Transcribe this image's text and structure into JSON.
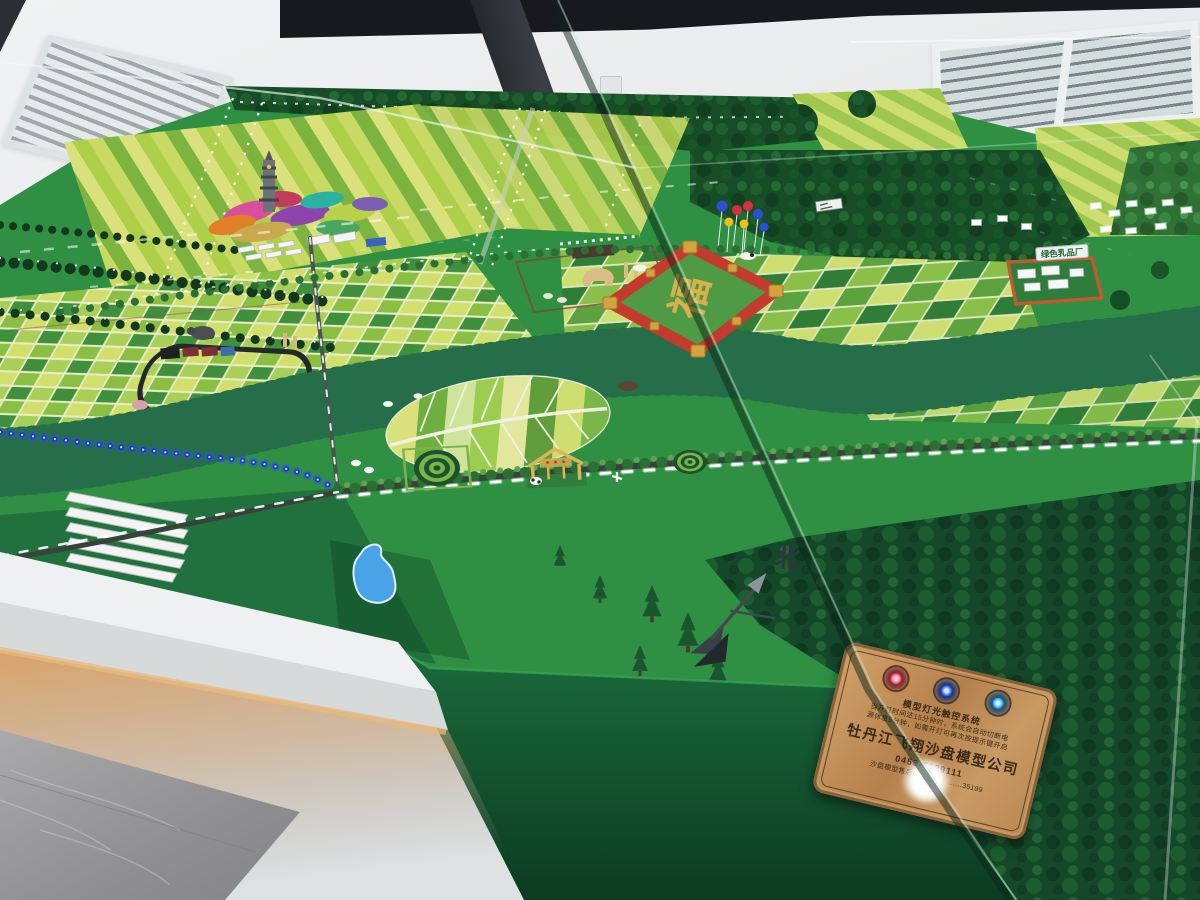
{
  "plaque": {
    "system_title": "模型灯光触控系统",
    "note_line1": "当开灯时间达15分钟时，系统会自动切断电",
    "note_line2": "源休息5分钟，如需开灯可再次按提示键开启",
    "company": "牡丹江飞翔沙盘模型公司",
    "phone": "0453-6629111",
    "hotline": "沙盘模型售后服务热线：……35199",
    "buttons": [
      {
        "name": "red-button",
        "color": "#ff4d6e"
      },
      {
        "name": "blue-button",
        "color": "#2f6bff"
      },
      {
        "name": "cyan-blue-button",
        "color": "#28a8ff"
      }
    ]
  },
  "model": {
    "north_label": "北",
    "emblem_character": "福",
    "factory_sign": "绿色乳品厂",
    "colors": {
      "turf": "#2f8f43",
      "forest_dark": "#174d26",
      "river_led_blue": "#1b34d6",
      "road_led_white": "#ffffff",
      "emblem_red": "#c23b2e",
      "emblem_gold": "#d9b04a",
      "lake_blue": "#4aa3e6",
      "plaque_copper": "#c0895a",
      "base_glow": "#d8a368"
    }
  }
}
